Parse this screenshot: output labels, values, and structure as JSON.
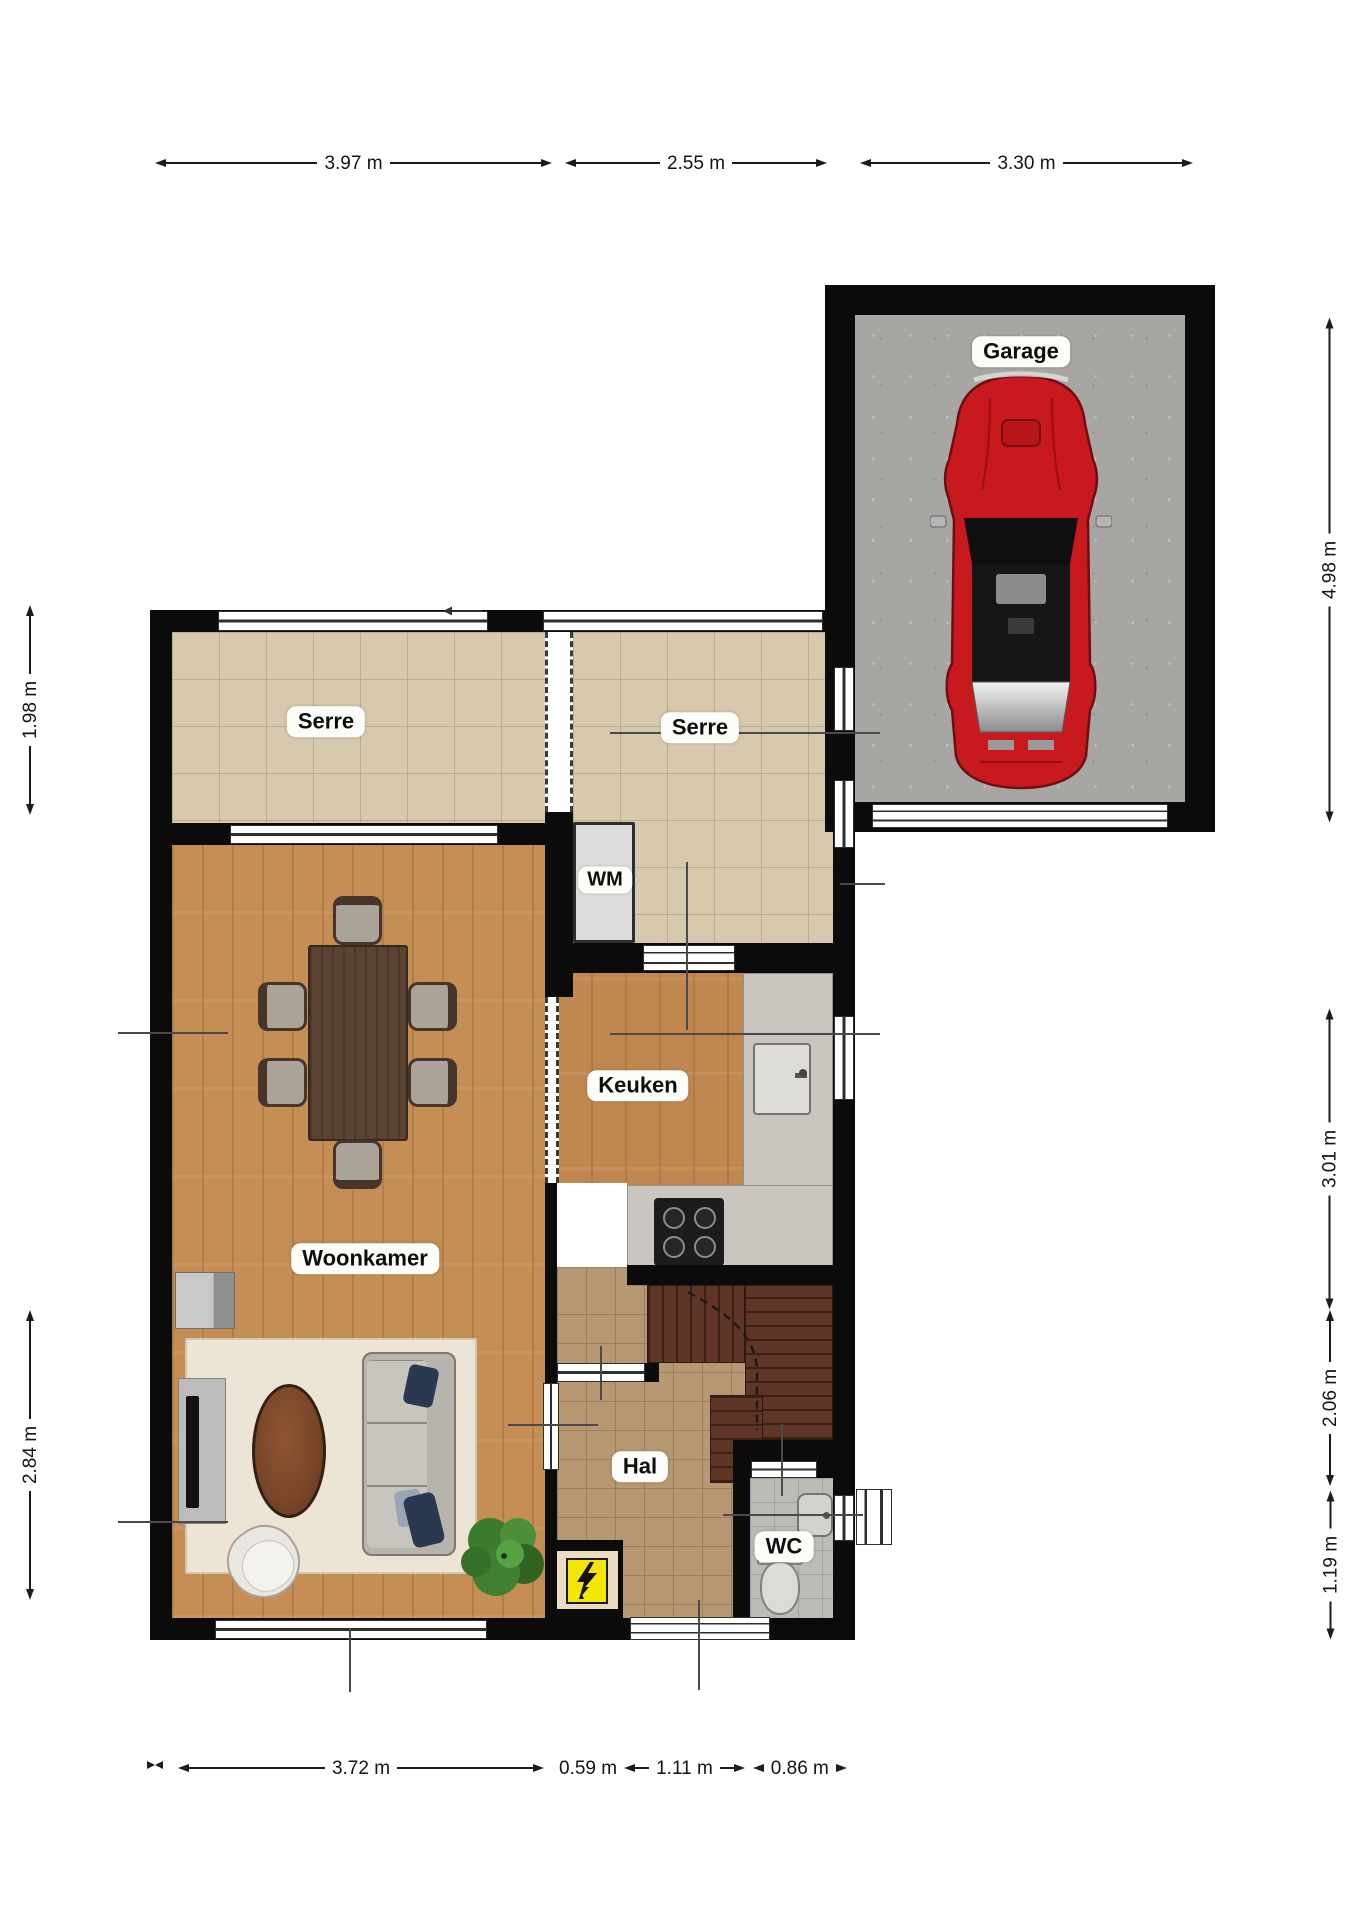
{
  "plan": {
    "type": "residential-floor-plan",
    "floor": "ground-floor"
  },
  "rooms": {
    "garage": {
      "label": "Garage"
    },
    "serre_left": {
      "label": "Serre"
    },
    "serre_right": {
      "label": "Serre"
    },
    "wm": {
      "label": "WM"
    },
    "keuken": {
      "label": "Keuken"
    },
    "woonkamer": {
      "label": "Woonkamer"
    },
    "hal": {
      "label": "Hal"
    },
    "wc": {
      "label": "WC"
    }
  },
  "dimensions": {
    "top": [
      {
        "label": "3.97 m"
      },
      {
        "label": "2.55 m"
      },
      {
        "label": "3.30 m"
      }
    ],
    "right": [
      {
        "label": "4.98 m"
      },
      {
        "label": "3.01 m"
      },
      {
        "label": "2.06 m"
      },
      {
        "label": "1.19 m"
      }
    ],
    "left": [
      {
        "label": "1.98 m"
      },
      {
        "label": "2.84 m"
      }
    ],
    "bottom": [
      {
        "label": "3.72 m"
      },
      {
        "label": "0.59 m"
      },
      {
        "label": "1.11 m"
      },
      {
        "label": "0.86 m"
      }
    ]
  },
  "icons": {
    "electric_meter": "lightning-bolt",
    "entrance_arrow": "left-arrow"
  },
  "colors": {
    "wall": "#0b0b0b",
    "car_red": "#c8191f",
    "meter_yellow": "#f5e60a",
    "serre_tile": "#d6c9ae",
    "hal_tile": "#b69873",
    "wc_tile": "#bdbbb6",
    "wood_floor": "#c58e55",
    "garage_floor": "#a8a6a2",
    "counter_gray": "#c9c6bf",
    "stairs_brown": "#5e3526"
  }
}
